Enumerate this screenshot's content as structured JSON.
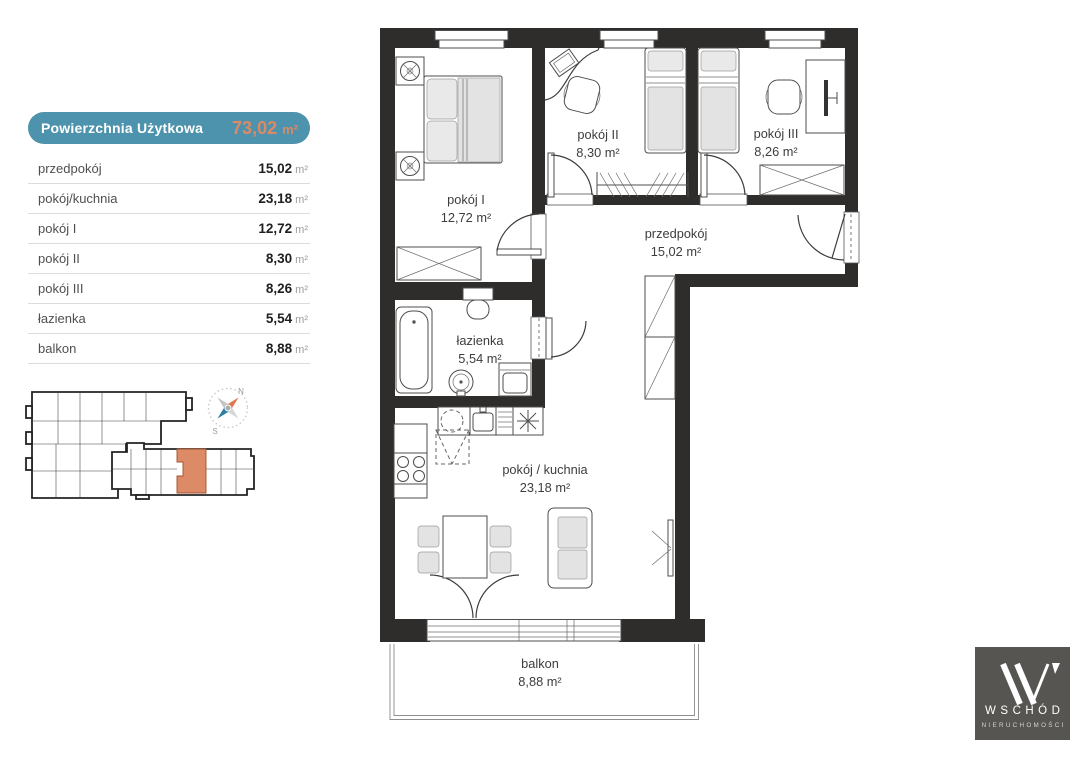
{
  "summary_table": {
    "header": {
      "label": "Powierzchnia Użytkowa",
      "value": "73,02",
      "unit": "m²"
    },
    "rows": [
      {
        "name": "przedpokój",
        "value": "15,02",
        "unit": "m²"
      },
      {
        "name": "pokój/kuchnia",
        "value": "23,18",
        "unit": "m²"
      },
      {
        "name": "pokój I",
        "value": "12,72",
        "unit": "m²"
      },
      {
        "name": "pokój II",
        "value": "8,30",
        "unit": "m²"
      },
      {
        "name": "pokój III",
        "value": "8,26",
        "unit": "m²"
      },
      {
        "name": "łazienka",
        "value": "5,54",
        "unit": "m²"
      },
      {
        "name": "balkon",
        "value": "8,88",
        "unit": "m²"
      }
    ]
  },
  "floor_plan": {
    "rooms": [
      {
        "name": "pokój I",
        "area": "12,72 m²"
      },
      {
        "name": "pokój II",
        "area": "8,30 m²"
      },
      {
        "name": "pokój III",
        "area": "8,26 m²"
      },
      {
        "name": "przedpokój",
        "area": "15,02 m²"
      },
      {
        "name": "łazienka",
        "area": "5,54 m²"
      },
      {
        "name": "pokój / kuchnia",
        "area": "23,18 m²"
      },
      {
        "name": "balkon",
        "area": "8,88 m²"
      }
    ]
  },
  "site_plan": {
    "compass": {
      "north": "N",
      "south": "S"
    }
  },
  "logo": {
    "name": "WSCHÓD",
    "tagline": "NIERUCHOMOŚCI"
  },
  "colors": {
    "teal": "#4e93ad",
    "orange": "#dc8a65",
    "wall": "#2f2d2c",
    "logo_background": "#575551"
  }
}
